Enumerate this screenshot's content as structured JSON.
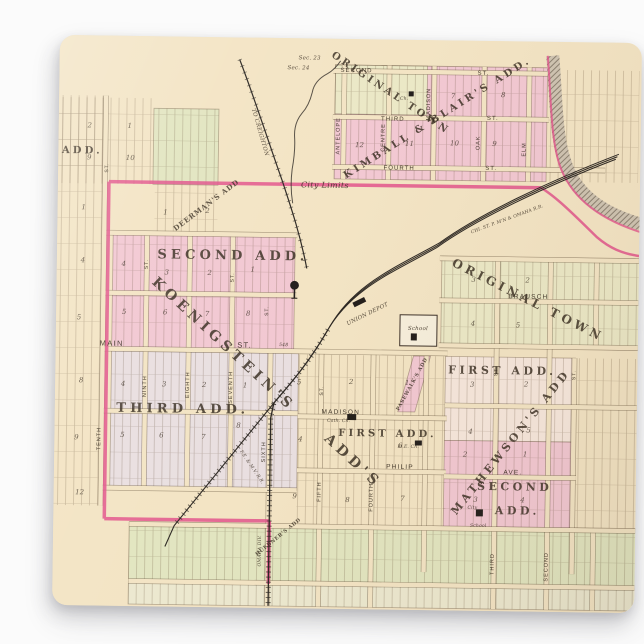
{
  "photo": {
    "background_color": "#fbfbfb",
    "paper_color": "#f3e4c4"
  },
  "map": {
    "colors": {
      "paper": "#f3e4c4",
      "pink_area": "#f2c8d2",
      "pink_line": "#e2558c",
      "yellow_area": "#ebe8c6",
      "green_area": "#e2e5c0",
      "lavender_area": "#e9dfe0",
      "ink": "#352b20",
      "rail": "#2e2924",
      "river": "#c7bba9"
    },
    "labels": [
      {
        "n": "label-original-town",
        "t": "ORIGINAL TOWN",
        "x": 330,
        "y": 56,
        "s": 10,
        "r": 33,
        "c": "b"
      },
      {
        "n": "label-kimball-blairs-add",
        "t": "KIMBALL & BLAIR'S ADD.",
        "x": 380,
        "y": 80,
        "s": 10,
        "r": -33,
        "c": "b"
      },
      {
        "n": "label-deermans-add",
        "t": "DEERMAN'S ADD",
        "x": 150,
        "y": 170,
        "s": 7,
        "r": -38,
        "c": "bs"
      },
      {
        "n": "label-second-add",
        "t": "SECOND ADD.",
        "x": 176,
        "y": 222,
        "s": 13,
        "c": "b"
      },
      {
        "n": "label-koenigsteins",
        "t": "KOENIGSTEIN'S",
        "x": 165,
        "y": 310,
        "s": 14,
        "r": 42,
        "c": "b"
      },
      {
        "n": "label-koenigsteins-adds",
        "t": "ADD'S",
        "x": 296,
        "y": 425,
        "s": 14,
        "r": 42,
        "c": "b"
      },
      {
        "n": "label-third-add",
        "t": "THIRD ADD.",
        "x": 128,
        "y": 376,
        "s": 13,
        "c": "b"
      },
      {
        "n": "label-first-add-center",
        "t": "FIRST ADD.",
        "x": 333,
        "y": 397,
        "s": 10,
        "c": "b"
      },
      {
        "n": "label-first-add-east",
        "t": "FIRST ADD.",
        "x": 447,
        "y": 333,
        "s": 11,
        "c": "b"
      },
      {
        "n": "label-mathewsons-add",
        "t": "MATHEWSON'S ADD",
        "x": 459,
        "y": 403,
        "s": 11,
        "r": -52,
        "c": "b"
      },
      {
        "n": "label-second-add-east-line1",
        "t": "SECOND",
        "x": 461,
        "y": 449,
        "s": 11,
        "c": "b"
      },
      {
        "n": "label-second-add-east-line2",
        "t": "ADD.",
        "x": 464,
        "y": 473,
        "s": 11,
        "c": "b"
      },
      {
        "n": "label-original-town-east",
        "t": "ORIGINAL TOWN",
        "x": 470,
        "y": 262,
        "s": 12,
        "r": 26,
        "c": "b"
      },
      {
        "n": "label-pasewalks-add",
        "t": "PASEWALK'S ADD",
        "x": 358,
        "y": 345,
        "s": 5,
        "r": -62,
        "c": "bs"
      },
      {
        "n": "label-huebners-add",
        "t": "HUEBNER'S ADD",
        "x": 226,
        "y": 500,
        "s": 5,
        "r": -40,
        "c": "bs"
      },
      {
        "n": "label-add-cutoff",
        "t": "ADD.",
        "x": 24,
        "y": 118,
        "s": 10,
        "c": "b"
      },
      {
        "t": "SECOND",
        "x": 297,
        "y": 33,
        "s": 6,
        "c": "st"
      },
      {
        "t": "ST.",
        "x": 424,
        "y": 34,
        "s": 6,
        "c": "st"
      },
      {
        "t": "THIRD",
        "x": 334,
        "y": 81,
        "s": 6,
        "c": "st"
      },
      {
        "t": "ST.",
        "x": 434,
        "y": 79,
        "s": 6,
        "c": "st"
      },
      {
        "t": "FOURTH",
        "x": 341,
        "y": 130,
        "s": 6,
        "c": "st"
      },
      {
        "t": "ST.",
        "x": 433,
        "y": 129,
        "s": 6,
        "c": "st"
      },
      {
        "t": "ANTELOPE",
        "x": 281,
        "y": 97,
        "s": 5.5,
        "r": -90,
        "c": "st"
      },
      {
        "t": "CENTRE",
        "x": 326,
        "y": 98,
        "s": 5.5,
        "r": -90,
        "c": "st"
      },
      {
        "t": "MADISON",
        "x": 371,
        "y": 64,
        "s": 5.5,
        "r": -90,
        "c": "st"
      },
      {
        "t": "OAK",
        "x": 421,
        "y": 102,
        "s": 5.5,
        "r": -90,
        "c": "st"
      },
      {
        "t": "ELM",
        "x": 467,
        "y": 108,
        "s": 5.5,
        "r": -90,
        "c": "st"
      },
      {
        "n": "label-city-limits",
        "t": "City Limits",
        "x": 267,
        "y": 149,
        "s": 8,
        "c": "it"
      },
      {
        "t": "Sec. 23",
        "x": 250,
        "y": 21,
        "s": 5.5,
        "c": "it"
      },
      {
        "t": "Sec. 24",
        "x": 239,
        "y": 31,
        "s": 5.5,
        "c": "it"
      },
      {
        "n": "label-to-creighton",
        "t": "TO CREIGHTON",
        "x": 200,
        "y": 95,
        "s": 5.5,
        "r": 73,
        "c": "it"
      },
      {
        "n": "label-omaha-railroad",
        "t": "CHI. ST. P. M'N & OMAHA R.R.",
        "x": 450,
        "y": 179,
        "s": 4.5,
        "r": -21,
        "c": "it"
      },
      {
        "n": "label-union-depot",
        "t": "UNION DEPOT",
        "x": 312,
        "y": 276,
        "s": 5.5,
        "r": -27,
        "c": "it"
      },
      {
        "t": "MAIN",
        "x": 56,
        "y": 310,
        "s": 7.5,
        "c": "st"
      },
      {
        "t": "ST.",
        "x": 189,
        "y": 310,
        "s": 7.5,
        "c": "st"
      },
      {
        "t": "548",
        "x": 228,
        "y": 308,
        "s": 4.5,
        "c": "it"
      },
      {
        "t": "MADISON",
        "x": 286,
        "y": 375,
        "s": 6.5,
        "c": "st"
      },
      {
        "t": "PHILIP",
        "x": 346,
        "y": 429,
        "s": 6.5,
        "c": "st"
      },
      {
        "t": "AVE.",
        "x": 459,
        "y": 433,
        "s": 6.5,
        "c": "st"
      },
      {
        "t": "BRAUSCH",
        "x": 472,
        "y": 257,
        "s": 6.5,
        "c": "st"
      },
      {
        "t": "TENTH",
        "x": 46,
        "y": 403,
        "s": 5.5,
        "r": -90,
        "c": "st"
      },
      {
        "t": "NINTH",
        "x": 91,
        "y": 350,
        "s": 5.5,
        "r": -90,
        "c": "st"
      },
      {
        "t": "EIGHTH",
        "x": 134,
        "y": 348,
        "s": 5.5,
        "r": -90,
        "c": "st"
      },
      {
        "t": "SEVENTH",
        "x": 177,
        "y": 350,
        "s": 5.5,
        "r": -90,
        "c": "st"
      },
      {
        "t": "SIXTH",
        "x": 211,
        "y": 414,
        "s": 5.5,
        "r": -90,
        "c": "st"
      },
      {
        "t": "FIFTH",
        "x": 267,
        "y": 453,
        "s": 5.5,
        "r": -90,
        "c": "st"
      },
      {
        "t": "FOURTH",
        "x": 319,
        "y": 458,
        "s": 5.5,
        "r": -90,
        "c": "st"
      },
      {
        "t": "THIRD",
        "x": 441,
        "y": 523,
        "s": 5.5,
        "r": -90,
        "c": "st"
      },
      {
        "t": "SECOND",
        "x": 495,
        "y": 525,
        "s": 5.5,
        "r": -90,
        "c": "st"
      },
      {
        "t": "ST.",
        "x": 50,
        "y": 132,
        "s": 5,
        "r": -90,
        "c": "st"
      },
      {
        "t": "ST.",
        "x": 91,
        "y": 228,
        "s": 5,
        "r": -90,
        "c": "st"
      },
      {
        "t": "ST.",
        "x": 177,
        "y": 240,
        "s": 5,
        "r": -90,
        "c": "st"
      },
      {
        "t": "ST.",
        "x": 212,
        "y": 273,
        "s": 5,
        "r": -90,
        "c": "st"
      },
      {
        "t": "ST.",
        "x": 268,
        "y": 352,
        "s": 5,
        "r": -90,
        "c": "st"
      },
      {
        "t": "ST.",
        "x": 442,
        "y": 330,
        "s": 5,
        "r": -90,
        "c": "st"
      },
      {
        "t": "ST.",
        "x": 520,
        "y": 333,
        "s": 5,
        "r": -90,
        "c": "st"
      },
      {
        "n": "label-omaha-div",
        "t": "OMAHA DIV.",
        "x": 208,
        "y": 513,
        "s": 4.5,
        "r": -90,
        "c": "it"
      },
      {
        "n": "label-femv-railroad",
        "t": "F.E. & M.V. R.R.",
        "x": 197,
        "y": 430,
        "s": 4.5,
        "r": 55,
        "c": "it"
      },
      {
        "n": "label-school",
        "t": "School",
        "x": 362,
        "y": 290,
        "s": 5.5,
        "c": "it"
      },
      {
        "n": "label-city-school-line1",
        "t": "City",
        "x": 419,
        "y": 468,
        "s": 4.5,
        "c": "it"
      },
      {
        "n": "label-city-school-line2",
        "t": "School",
        "x": 425,
        "y": 486,
        "s": 4.5,
        "c": "it"
      },
      {
        "n": "label-catholic-church",
        "t": "Cath. Ch.",
        "x": 284,
        "y": 383,
        "s": 4.5,
        "c": "it"
      },
      {
        "n": "label-me-church",
        "t": "M.E. Ch.",
        "x": 354,
        "y": 408,
        "s": 4.5,
        "c": "it"
      },
      {
        "n": "label-church",
        "t": "Ch.",
        "x": 345,
        "y": 60,
        "s": 4.5,
        "c": "it"
      },
      {
        "t": "2",
        "x": 31,
        "y": 92,
        "s": 7,
        "c": "n"
      },
      {
        "t": "1",
        "x": 71,
        "y": 92,
        "s": 7,
        "c": "n"
      },
      {
        "t": "9",
        "x": 31,
        "y": 124,
        "s": 7,
        "c": "n"
      },
      {
        "t": "10",
        "x": 72,
        "y": 124,
        "s": 7,
        "c": "n"
      },
      {
        "t": "1",
        "x": 108,
        "y": 178,
        "s": 7,
        "c": "n"
      },
      {
        "t": "2",
        "x": 150,
        "y": 176,
        "s": 7,
        "c": "n"
      },
      {
        "t": "1",
        "x": 26,
        "y": 174,
        "s": 7,
        "c": "n"
      },
      {
        "t": "4",
        "x": 26,
        "y": 227,
        "s": 7,
        "c": "n"
      },
      {
        "t": "5",
        "x": 23,
        "y": 284,
        "s": 7,
        "c": "n"
      },
      {
        "t": "8",
        "x": 26,
        "y": 347,
        "s": 7,
        "c": "n"
      },
      {
        "t": "9",
        "x": 22,
        "y": 404,
        "s": 7,
        "c": "n"
      },
      {
        "t": "12",
        "x": 26,
        "y": 459,
        "s": 7,
        "c": "n"
      },
      {
        "t": "4",
        "x": 67,
        "y": 230,
        "s": 7,
        "c": "n"
      },
      {
        "t": "3",
        "x": 110,
        "y": 238,
        "s": 7,
        "c": "n"
      },
      {
        "t": "2",
        "x": 153,
        "y": 238,
        "s": 7,
        "c": "n"
      },
      {
        "t": "1",
        "x": 196,
        "y": 234,
        "s": 7,
        "c": "n"
      },
      {
        "t": "5",
        "x": 68,
        "y": 278,
        "s": 7,
        "c": "n"
      },
      {
        "t": "6",
        "x": 109,
        "y": 278,
        "s": 7,
        "c": "n"
      },
      {
        "t": "7",
        "x": 151,
        "y": 279,
        "s": 7,
        "c": "n"
      },
      {
        "t": "8",
        "x": 192,
        "y": 278,
        "s": 7,
        "c": "n"
      },
      {
        "t": "4",
        "x": 68,
        "y": 350,
        "s": 7,
        "c": "n"
      },
      {
        "t": "3",
        "x": 109,
        "y": 350,
        "s": 7,
        "c": "n"
      },
      {
        "t": "2",
        "x": 149,
        "y": 350,
        "s": 7,
        "c": "n"
      },
      {
        "t": "1",
        "x": 190,
        "y": 350,
        "s": 7,
        "c": "n"
      },
      {
        "t": "5",
        "x": 68,
        "y": 401,
        "s": 7,
        "c": "n"
      },
      {
        "t": "6",
        "x": 107,
        "y": 401,
        "s": 7,
        "c": "n"
      },
      {
        "t": "7",
        "x": 149,
        "y": 402,
        "s": 7,
        "c": "n"
      },
      {
        "t": "8",
        "x": 184,
        "y": 390,
        "s": 7,
        "c": "n"
      },
      {
        "t": "9",
        "x": 241,
        "y": 460,
        "s": 7,
        "c": "n"
      },
      {
        "t": "5",
        "x": 244,
        "y": 346,
        "s": 7,
        "c": "n"
      },
      {
        "t": "2",
        "x": 296,
        "y": 345,
        "s": 7,
        "c": "n"
      },
      {
        "t": "1",
        "x": 352,
        "y": 345,
        "s": 7,
        "c": "n"
      },
      {
        "t": "4",
        "x": 246,
        "y": 403,
        "s": 7,
        "c": "n"
      },
      {
        "t": "6",
        "x": 346,
        "y": 408,
        "s": 7,
        "c": "n"
      },
      {
        "t": "8",
        "x": 294,
        "y": 463,
        "s": 7,
        "c": "n"
      },
      {
        "t": "7",
        "x": 349,
        "y": 461,
        "s": 7,
        "c": "n"
      },
      {
        "t": "7",
        "x": 394,
        "y": 58,
        "s": 7,
        "c": "n"
      },
      {
        "t": "8",
        "x": 444,
        "y": 56,
        "s": 7,
        "c": "n"
      },
      {
        "t": "12",
        "x": 301,
        "y": 108,
        "s": 7,
        "c": "n"
      },
      {
        "t": "11",
        "x": 351,
        "y": 106,
        "s": 7,
        "c": "n"
      },
      {
        "t": "10",
        "x": 396,
        "y": 105,
        "s": 7,
        "c": "n"
      },
      {
        "t": "9",
        "x": 436,
        "y": 105,
        "s": 7,
        "c": "n"
      },
      {
        "t": "3",
        "x": 417,
        "y": 241,
        "s": 7,
        "c": "n"
      },
      {
        "t": "2",
        "x": 471,
        "y": 241,
        "s": 7,
        "c": "n"
      },
      {
        "t": "4",
        "x": 417,
        "y": 285,
        "s": 7,
        "c": "n"
      },
      {
        "t": "5",
        "x": 462,
        "y": 286,
        "s": 7,
        "c": "n"
      },
      {
        "t": "3",
        "x": 417,
        "y": 346,
        "s": 7,
        "c": "n"
      },
      {
        "t": "2",
        "x": 471,
        "y": 345,
        "s": 7,
        "c": "n"
      },
      {
        "t": "4",
        "x": 416,
        "y": 393,
        "s": 7,
        "c": "n"
      },
      {
        "t": "5",
        "x": 474,
        "y": 391,
        "s": 7,
        "c": "n"
      },
      {
        "t": "2",
        "x": 411,
        "y": 416,
        "s": 7,
        "c": "n"
      },
      {
        "t": "1",
        "x": 471,
        "y": 415,
        "s": 7,
        "c": "n"
      },
      {
        "t": "3",
        "x": 422,
        "y": 461,
        "s": 7,
        "c": "n"
      },
      {
        "t": "4",
        "x": 469,
        "y": 461,
        "s": 7,
        "c": "n"
      }
    ],
    "symbols": [
      {
        "n": "water-tower-icon",
        "type": "water-tower",
        "x": 238,
        "y": 247
      },
      {
        "n": "union-depot-building",
        "type": "building",
        "x": 303,
        "y": 263,
        "w": 13,
        "h": 5,
        "r": -27
      },
      {
        "n": "school-building",
        "type": "building",
        "x": 358,
        "y": 297,
        "w": 6,
        "h": 7
      },
      {
        "n": "city-school-building",
        "type": "building",
        "x": 426,
        "y": 472,
        "w": 7,
        "h": 7
      },
      {
        "n": "catholic-church-building",
        "type": "building",
        "x": 297,
        "y": 378,
        "w": 9,
        "h": 6
      },
      {
        "n": "me-church-building",
        "type": "building",
        "x": 364,
        "y": 403,
        "w": 7,
        "h": 5
      },
      {
        "n": "church-building-original-town",
        "type": "building",
        "x": 352,
        "y": 54,
        "w": 5,
        "h": 5
      }
    ]
  }
}
